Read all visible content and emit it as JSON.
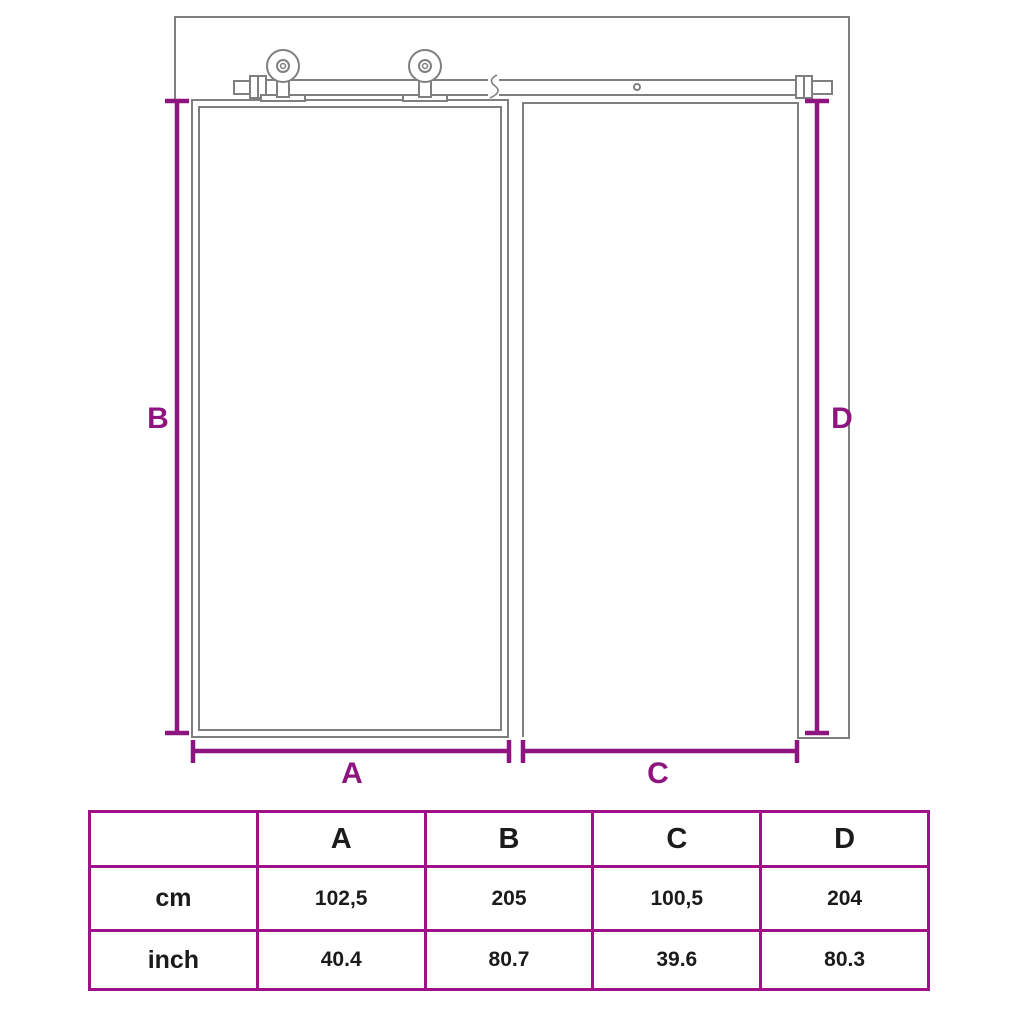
{
  "diagram": {
    "dimension_labels": {
      "a": "A",
      "b": "B",
      "c": "C",
      "d": "D"
    }
  },
  "table": {
    "corner_label": "",
    "columns": [
      "A",
      "B",
      "C",
      "D"
    ],
    "rows": [
      {
        "label": "cm",
        "values": [
          "102,5",
          "205",
          "100,5",
          "204"
        ]
      },
      {
        "label": "inch",
        "values": [
          "40.4",
          "80.7",
          "39.6",
          "80.3"
        ]
      }
    ]
  },
  "colors": {
    "dimension_purple": "#8E1580",
    "table_border_purple": "#A01189",
    "line_gray": "#7F7F7F"
  }
}
